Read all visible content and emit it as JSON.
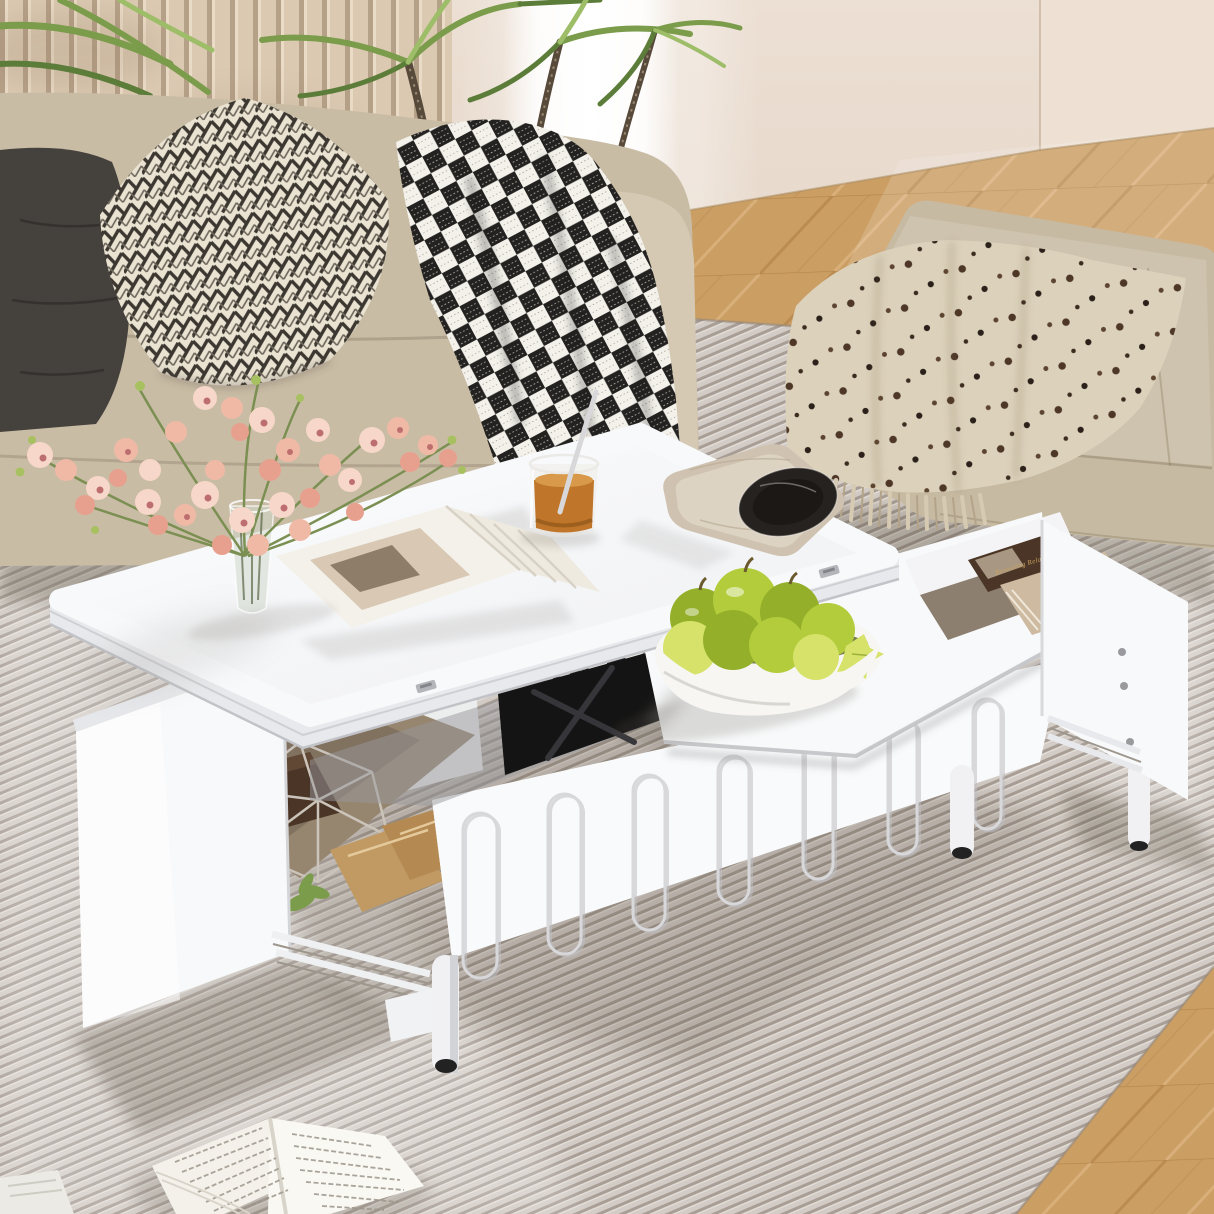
{
  "meta": {
    "type": "lifestyle-product-photo",
    "subject": "White lift-top multifunctional coffee table with open storage drawers in a bright beige living room"
  },
  "text": {
    "drawer_book_spine": "Revealing Relaxation"
  },
  "counts": {
    "arch_grooves": 7,
    "table_legs": 3,
    "hinges": 2
  },
  "palette": {
    "wall": "#e8dbce",
    "wallRight": "#eee1d4",
    "slatLight": "#dbc9b2",
    "slatDark": "#b5a088",
    "floorBase": "#cb9e64",
    "floorSeamDark": "#b5854b",
    "floorSeamLight": "#d9af7a",
    "rugBase": "#d3ccc6",
    "rugRib": "#a89e96",
    "sofaBase": "#c9bca5",
    "sofaArm": "#d5c9b4",
    "pillowDark": "#45413d",
    "pillowCream": "#eae3d2",
    "pillowZig": "#3c3831",
    "plaidWhite": "#f3f1ea",
    "plaidBlack": "#242220",
    "stem": "#584a3b",
    "leaf": "#7a9c4b",
    "leafDark": "#5b7d39",
    "leafLight": "#9dbd68",
    "ottoman": "#c7baa3",
    "throwCream": "#dcd2bc",
    "throwDot": "#4e3727",
    "throwDotDark": "#2b211a",
    "tableWhite": "#f8f9fa",
    "tableEdge": "#e8e9ec",
    "gapBlack": "#141414",
    "mech": "#35353a",
    "drawerInterior": "#97866f",
    "bookBrown": "#4b3526",
    "bookBeige": "#cdbaa0",
    "bagKraft": "#c09a62",
    "wire": "#cac4ba",
    "legWhite": "#f1f1f4",
    "legFoot": "#222222",
    "flowerLight": "#f7d7c9",
    "flowerMid": "#f0b9a6",
    "flowerDeep": "#e8a08e",
    "flowerCenter": "#bd6f6f",
    "budGreen": "#a7c161",
    "flowerStem": "#7b8f52",
    "vaseGlass": "#cfd8cc",
    "amber": "#c0762a",
    "trayStone": "#cfc2b0",
    "plateBlack": "#26221f",
    "apple": "#b3cc3c",
    "appleDark": "#94b02a",
    "appleLight": "#d6e269",
    "bowlWhite": "#f7f6f3",
    "bowlInner": "#62662f",
    "pageWhite": "#f4f1ea",
    "textLine": "#9c958a",
    "spineGold": "#c9a05e"
  }
}
